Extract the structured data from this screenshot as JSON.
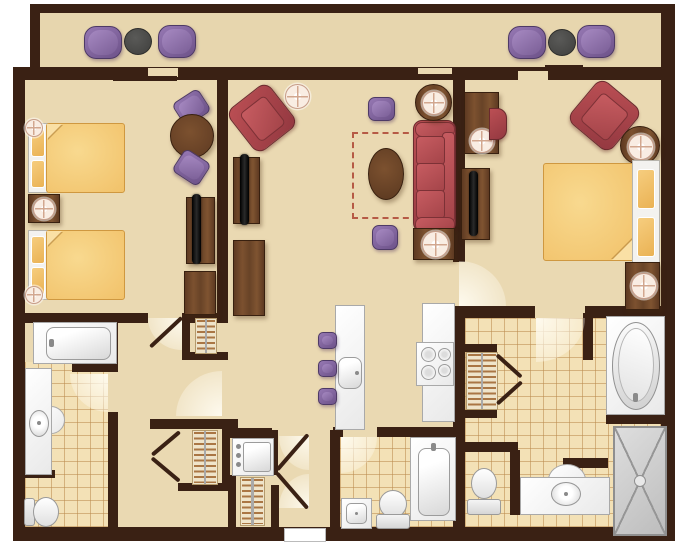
{
  "title": "two-bedroom-suite-floor-plan",
  "colors": {
    "wall": "#3a2114",
    "floor": "#ead9b2",
    "balcony_floor": "#e7d6ae",
    "tile": "#f3e1b6",
    "tile_line": "rgba(186,138,77,0.55)",
    "dashed": "#b65a45",
    "wood": "#6b4629",
    "red_upholstery": "#ae464c",
    "purple_upholstery": "#8165a0",
    "bed_orange": "#f2c170",
    "fixture_white": "#f5f5f5",
    "balcony_table_gray": "#4e4e4c",
    "shower_gray": "#cccccc"
  },
  "floor_plan": {
    "type": "residential-floorplan",
    "rooms": [
      {
        "name": "balcony",
        "furniture": [
          "lounge-chair",
          "round-side-table",
          "lounge-chair",
          "lounge-chair",
          "round-side-table",
          "lounge-chair"
        ]
      },
      {
        "name": "bedroom-1",
        "furniture": [
          "queen-bed",
          "queen-bed",
          "nightstand-with-lamp",
          "corner-lamp",
          "corner-lamp",
          "round-dining-table",
          "dining-chair",
          "dining-chair",
          "tv-console-with-tv",
          "dresser"
        ]
      },
      {
        "name": "living-room",
        "furniture": [
          "armchair",
          "floor-lamp",
          "tv-console-with-tv",
          "console-dresser",
          "sleeper-sofa-dashed-outline",
          "oval-coffee-table",
          "sofa",
          "ottoman",
          "ottoman",
          "round-end-table-with-lamp",
          "end-table-with-lamp"
        ]
      },
      {
        "name": "kitchen",
        "furniture": [
          "island-counter-with-sink",
          "bar-stool",
          "bar-stool",
          "bar-stool",
          "counter",
          "range-stove"
        ]
      },
      {
        "name": "entry-hall",
        "furniture": [
          "louvered-closet",
          "louvered-closet",
          "stacked-washer-dryer",
          "louvered-closet",
          "double-entry-doors"
        ]
      },
      {
        "name": "bathroom-1",
        "furniture": [
          "bathtub",
          "vanity-with-sink",
          "toilet"
        ]
      },
      {
        "name": "bathroom-2",
        "furniture": [
          "bathtub",
          "square-sink",
          "toilet"
        ]
      },
      {
        "name": "master-bedroom",
        "furniture": [
          "king-bed",
          "nightstand-with-lamp",
          "desk-with-lamp",
          "desk-chair",
          "armchair",
          "round-end-table-with-lamp",
          "tv-console-with-tv"
        ]
      },
      {
        "name": "master-bathroom",
        "furniture": [
          "soaking-tub",
          "walk-in-shower",
          "vanity-with-sink",
          "toilet",
          "louvered-closet"
        ]
      }
    ]
  }
}
